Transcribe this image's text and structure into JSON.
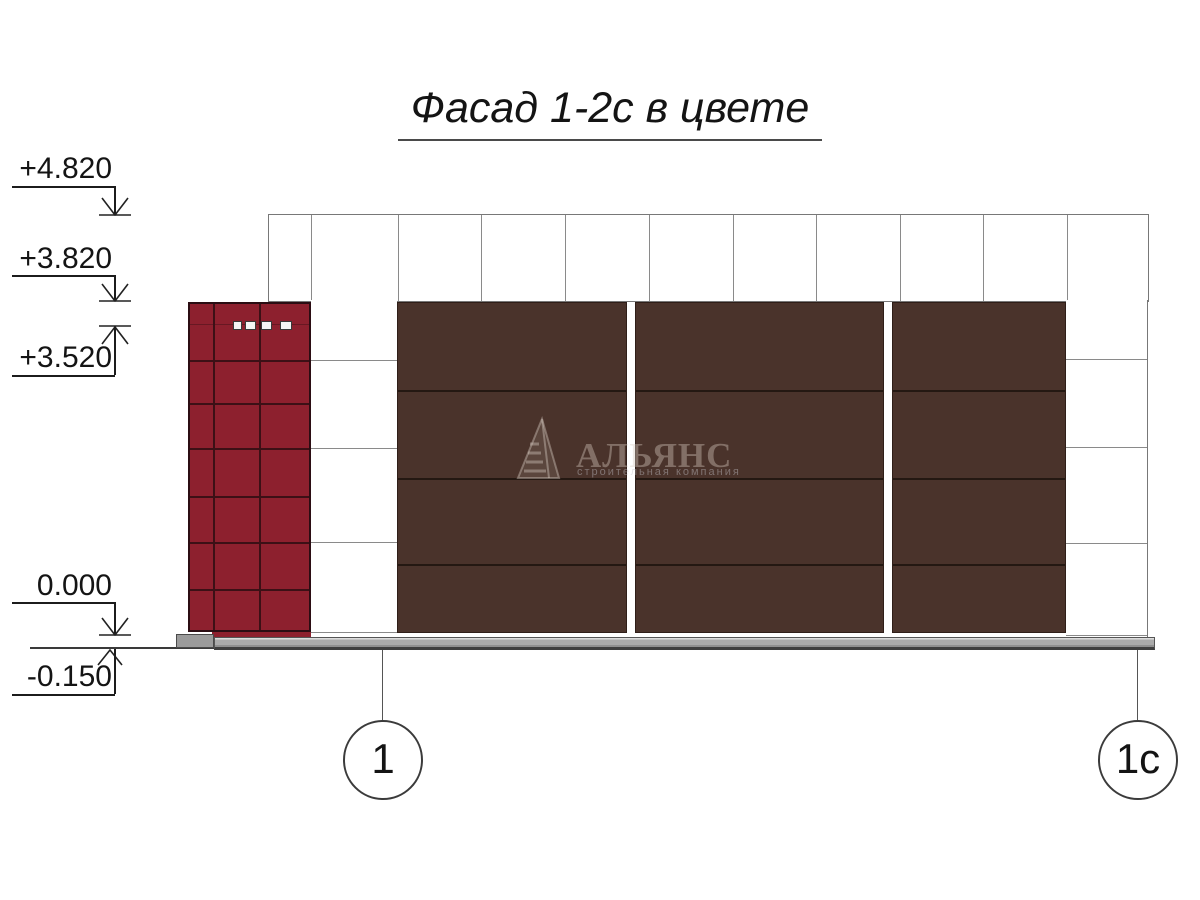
{
  "title": {
    "text": "Фасад 1-2с в цвете"
  },
  "elevation_marks": [
    {
      "label": "+4.820"
    },
    {
      "label": "+3.820"
    },
    {
      "label": "+3.520"
    },
    {
      "label": "0.000"
    },
    {
      "label": "-0.150"
    }
  ],
  "axes": [
    {
      "label": "1"
    },
    {
      "label": "1с"
    }
  ],
  "watermark": {
    "name": "АЛЬЯНС",
    "subtitle": "строительная компания"
  },
  "colors": {
    "facade_red": "#8d202e",
    "panel_brown": "#4a332b",
    "plinth_gray": "#ababab",
    "line_gray": "#8a8a8a"
  }
}
